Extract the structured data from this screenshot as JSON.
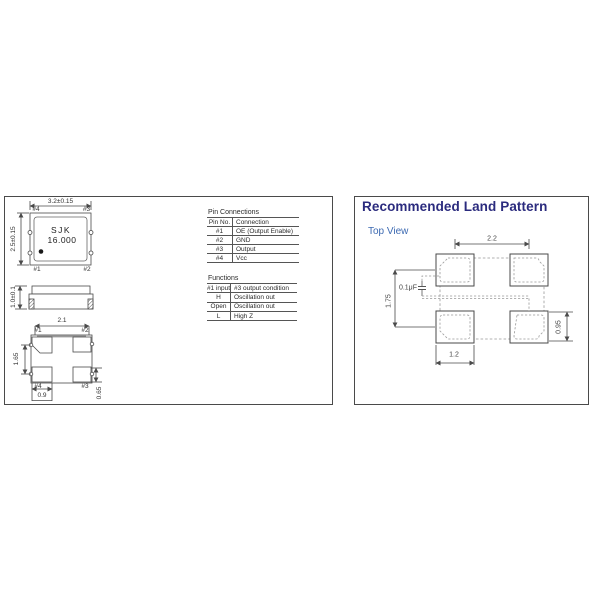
{
  "left_panel": {
    "top_view": {
      "brand": "SJK",
      "frequency": "16.000",
      "dim_width": "3.2±0.15",
      "dim_height": "2.5±0.15",
      "pins": {
        "top_left": "#4",
        "top_right": "#3",
        "bottom_left": "#1",
        "bottom_right": "#2"
      }
    },
    "side_view": {
      "dim_height": "1.0±0.1"
    },
    "bottom_view": {
      "dim_pitch_x": "2.1",
      "dim_pitch_y": "1.65",
      "dim_pad_w": "0.9",
      "dim_pad_h": "0.65",
      "pins": {
        "top_left": "#1",
        "top_right": "#2",
        "bottom_left": "#4",
        "bottom_right": "#3"
      }
    },
    "pin_connections": {
      "title": "Pin Connections",
      "headers": [
        "Pin No.",
        "Connection"
      ],
      "rows": [
        [
          "#1",
          "OE (Output Enable)"
        ],
        [
          "#2",
          "GND"
        ],
        [
          "#3",
          "Output"
        ],
        [
          "#4",
          "Vcc"
        ]
      ]
    },
    "functions": {
      "title": "Functions",
      "headers": [
        "#1 input",
        "#3 output condition"
      ],
      "rows": [
        [
          "H",
          "Oscillation out"
        ],
        [
          "Open",
          "Oscillation out"
        ],
        [
          "L",
          "High Z"
        ]
      ]
    }
  },
  "right_panel": {
    "title": "Recommended Land Pattern",
    "subtitle": "Top View",
    "capacitor": "0.1μF",
    "dims": {
      "pitch_x": "2.2",
      "pitch_y": "1.75",
      "pad_w": "1.2",
      "pad_h": "0.95"
    },
    "colors": {
      "title": "#2b2b7e",
      "subtitle": "#3d6ab2",
      "line": "#4a4a4a"
    }
  }
}
